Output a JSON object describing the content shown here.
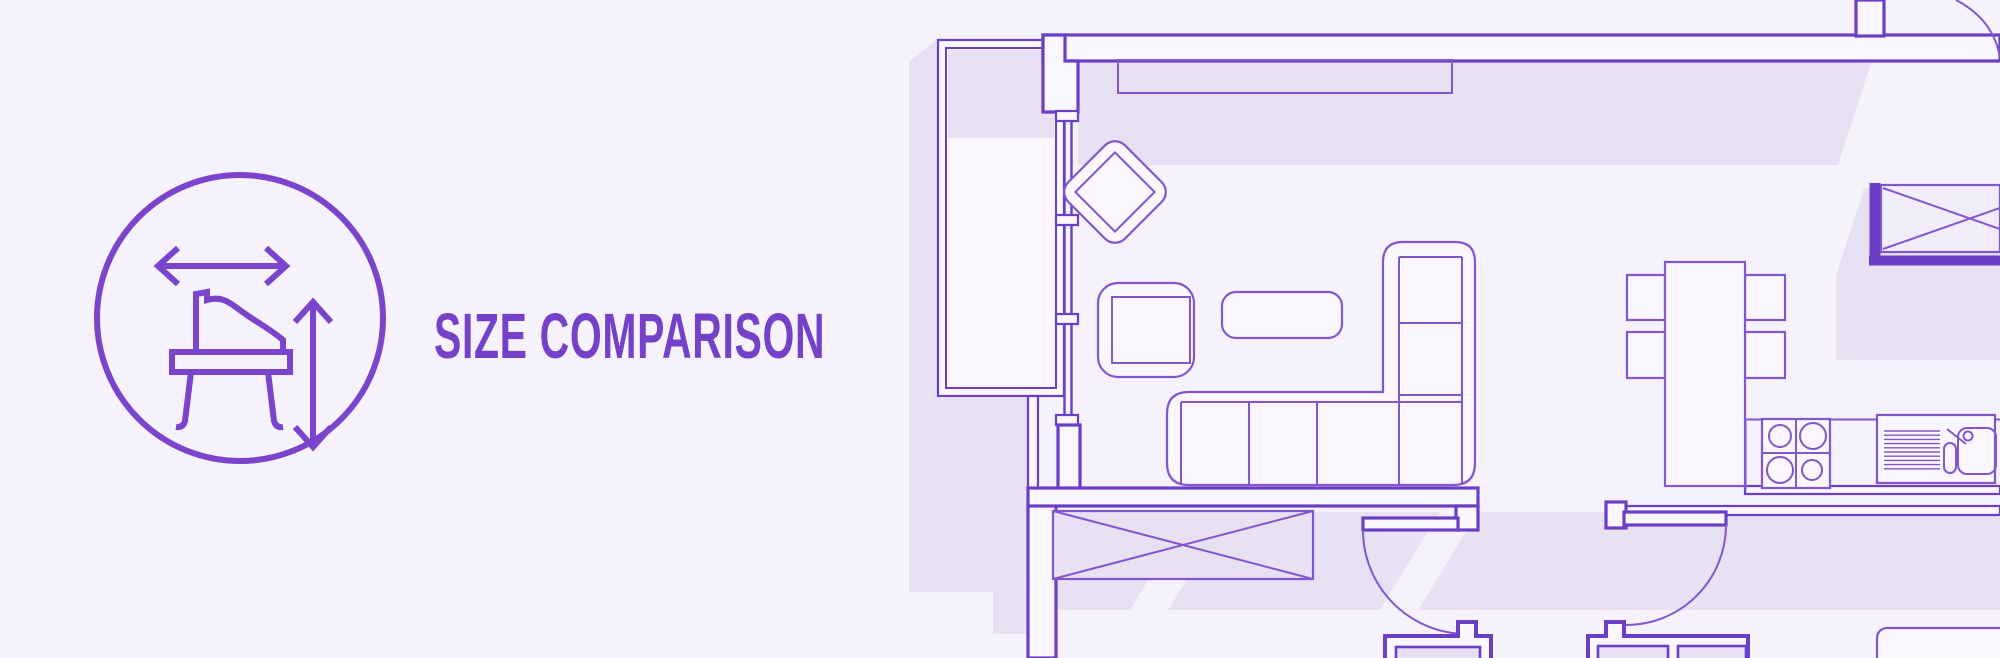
{
  "banner": {
    "title": "SIZE COMPARISON"
  },
  "badge": {
    "icon": "piano-size-badge",
    "parts": [
      "grand-piano-side-icon",
      "width-arrow-icon",
      "height-arrow-icon"
    ]
  },
  "theme": {
    "bg": "#F5F2FB",
    "shadow": "#E8E1F4",
    "wall": "#6B3EC6",
    "furn": "#8257CB",
    "accent": "#7A45CC",
    "accent-text": "#7442C9",
    "fill": "#F9F6FD"
  },
  "floorplan": {
    "label": "apartment-floor-plan",
    "elements": [
      "balcony",
      "sliding-door",
      "living-room",
      "diamond-armchair",
      "armchair",
      "coffee-table",
      "corner-sofa",
      "wall-shelf",
      "dining-table",
      "chairs",
      "kitchen-counter",
      "stove",
      "sink",
      "wardrobe",
      "doors",
      "door-sills",
      "window"
    ]
  }
}
